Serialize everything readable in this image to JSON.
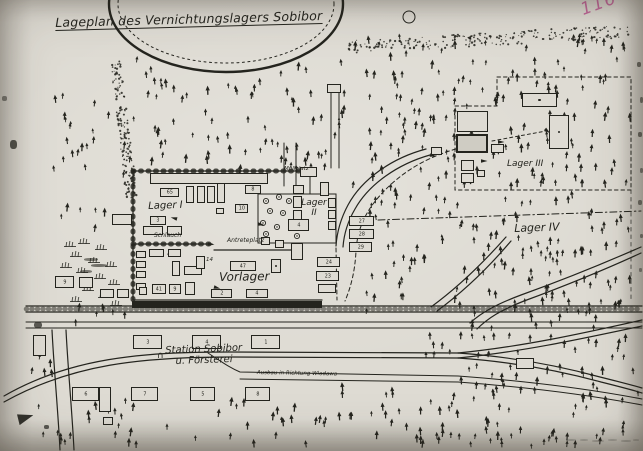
{
  "document": {
    "title": "Lageplan des Vernichtungslagers Sobibor",
    "page_annotation": "116"
  },
  "colors": {
    "paper": "#dedbd3",
    "ink": "#24241e",
    "annotation": "#b8538c"
  },
  "map": {
    "labels": [
      {
        "id": "lager-i",
        "text": "Lager I",
        "x": 148,
        "y": 201,
        "fs": 10,
        "rot": -2
      },
      {
        "id": "lager-ii",
        "text": "Lager\nII",
        "x": 299,
        "y": 198,
        "fs": 9,
        "w": 30,
        "align": "center"
      },
      {
        "id": "lager-iii",
        "text": "Lager III",
        "x": 507,
        "y": 159,
        "fs": 9
      },
      {
        "id": "lager-iv",
        "text": "Lager IV",
        "x": 514,
        "y": 223,
        "fs": 11,
        "rot": -2
      },
      {
        "id": "vorlager",
        "text": "Vorlager",
        "x": 219,
        "y": 271,
        "fs": 12,
        "rot": -1
      },
      {
        "id": "station",
        "text": "Station Sobibor\nu. Försterei",
        "x": 146,
        "y": 346,
        "fs": 10,
        "rot": -2,
        "w": 115,
        "align": "center"
      },
      {
        "id": "ausbau-richtung",
        "text": "Ausbau in Richtung Wlodawa",
        "x": 257,
        "y": 370,
        "fs": 5.5,
        "rot": 1
      },
      {
        "id": "schlauch",
        "text": "Schlauch",
        "x": 154,
        "y": 233,
        "fs": 6
      },
      {
        "id": "antreteplatz",
        "text": "Antreteplatz",
        "x": 227,
        "y": 238,
        "fs": 6
      },
      {
        "id": "muellplatz",
        "text": "Müllplatz",
        "x": 284,
        "y": 166,
        "fs": 5.5
      },
      {
        "id": "building-14-number",
        "text": "14",
        "x": 206,
        "y": 257,
        "fs": 5.5
      },
      {
        "id": "pen-arc-mark",
        "text": "∩",
        "x": 157,
        "y": 351,
        "fs": 9
      }
    ],
    "buildings": [
      {
        "x": 150,
        "y": 173,
        "w": 118,
        "h": 11,
        "n": ""
      },
      {
        "x": 160,
        "y": 188,
        "w": 19,
        "h": 9,
        "n": "65"
      },
      {
        "x": 186,
        "y": 186,
        "w": 8,
        "h": 17,
        "n": ""
      },
      {
        "x": 197,
        "y": 186,
        "w": 8,
        "h": 17,
        "n": ""
      },
      {
        "x": 207,
        "y": 186,
        "w": 8,
        "h": 17,
        "n": ""
      },
      {
        "x": 217,
        "y": 183,
        "w": 8,
        "h": 20,
        "n": ""
      },
      {
        "x": 245,
        "y": 185,
        "w": 16,
        "h": 9,
        "n": "8"
      },
      {
        "x": 112,
        "y": 214,
        "w": 20,
        "h": 11,
        "n": ""
      },
      {
        "x": 150,
        "y": 216,
        "w": 16,
        "h": 9,
        "n": "3"
      },
      {
        "x": 143,
        "y": 226,
        "w": 20,
        "h": 9,
        "n": ""
      },
      {
        "x": 167,
        "y": 226,
        "w": 15,
        "h": 9,
        "n": ""
      },
      {
        "x": 235,
        "y": 204,
        "w": 13,
        "h": 9,
        "n": "10"
      },
      {
        "x": 216,
        "y": 208,
        "w": 8,
        "h": 6,
        "n": ""
      },
      {
        "x": 293,
        "y": 185,
        "w": 11,
        "h": 9,
        "n": ""
      },
      {
        "x": 293,
        "y": 196,
        "w": 9,
        "h": 12,
        "n": ""
      },
      {
        "x": 293,
        "y": 210,
        "w": 9,
        "h": 10,
        "n": ""
      },
      {
        "x": 293,
        "y": 222,
        "w": 9,
        "h": 9,
        "n": ""
      },
      {
        "x": 291,
        "y": 243,
        "w": 12,
        "h": 17,
        "n": ""
      },
      {
        "x": 300,
        "y": 167,
        "w": 17,
        "h": 10,
        "n": ""
      },
      {
        "x": 327,
        "y": 84,
        "w": 14,
        "h": 9,
        "n": ""
      },
      {
        "x": 320,
        "y": 182,
        "w": 9,
        "h": 14,
        "n": ""
      },
      {
        "x": 328,
        "y": 198,
        "w": 8,
        "h": 10,
        "n": ""
      },
      {
        "x": 328,
        "y": 210,
        "w": 8,
        "h": 9,
        "n": ""
      },
      {
        "x": 328,
        "y": 221,
        "w": 8,
        "h": 9,
        "n": ""
      },
      {
        "x": 288,
        "y": 219,
        "w": 21,
        "h": 12,
        "n": "4"
      },
      {
        "x": 261,
        "y": 237,
        "w": 9,
        "h": 8,
        "n": ""
      },
      {
        "x": 275,
        "y": 240,
        "w": 9,
        "h": 8,
        "n": ""
      },
      {
        "x": 349,
        "y": 216,
        "w": 25,
        "h": 10,
        "n": "27"
      },
      {
        "x": 349,
        "y": 229,
        "w": 25,
        "h": 10,
        "n": "28"
      },
      {
        "x": 349,
        "y": 242,
        "w": 23,
        "h": 10,
        "n": "29"
      },
      {
        "x": 317,
        "y": 257,
        "w": 23,
        "h": 10,
        "n": "24"
      },
      {
        "x": 316,
        "y": 271,
        "w": 23,
        "h": 10,
        "n": "23"
      },
      {
        "x": 318,
        "y": 284,
        "w": 18,
        "h": 9,
        "n": ""
      },
      {
        "x": 136,
        "y": 251,
        "w": 10,
        "h": 7,
        "n": ""
      },
      {
        "x": 136,
        "y": 261,
        "w": 10,
        "h": 7,
        "n": ""
      },
      {
        "x": 136,
        "y": 271,
        "w": 10,
        "h": 7,
        "n": ""
      },
      {
        "x": 136,
        "y": 283,
        "w": 10,
        "h": 7,
        "n": ""
      },
      {
        "x": 149,
        "y": 249,
        "w": 15,
        "h": 8,
        "n": ""
      },
      {
        "x": 168,
        "y": 249,
        "w": 13,
        "h": 8,
        "n": ""
      },
      {
        "x": 172,
        "y": 261,
        "w": 8,
        "h": 15,
        "n": ""
      },
      {
        "x": 184,
        "y": 266,
        "w": 18,
        "h": 9,
        "n": ""
      },
      {
        "x": 196,
        "y": 256,
        "w": 9,
        "h": 13,
        "n": ""
      },
      {
        "x": 100,
        "y": 289,
        "w": 14,
        "h": 9,
        "n": ""
      },
      {
        "x": 117,
        "y": 289,
        "w": 12,
        "h": 9,
        "n": ""
      },
      {
        "x": 139,
        "y": 287,
        "w": 8,
        "h": 8,
        "n": ""
      },
      {
        "x": 152,
        "y": 284,
        "w": 14,
        "h": 10,
        "n": "41"
      },
      {
        "x": 169,
        "y": 284,
        "w": 12,
        "h": 10,
        "n": "9"
      },
      {
        "x": 185,
        "y": 282,
        "w": 10,
        "h": 13,
        "n": ""
      },
      {
        "x": 230,
        "y": 261,
        "w": 26,
        "h": 10,
        "n": "47"
      },
      {
        "x": 271,
        "y": 259,
        "w": 10,
        "h": 14,
        "n": "",
        "style": "dot"
      },
      {
        "x": 211,
        "y": 289,
        "w": 21,
        "h": 9,
        "n": "2"
      },
      {
        "x": 246,
        "y": 289,
        "w": 22,
        "h": 9,
        "n": "4"
      },
      {
        "x": 522,
        "y": 93,
        "w": 35,
        "h": 14,
        "n": "",
        "style": "dot"
      },
      {
        "x": 549,
        "y": 115,
        "w": 20,
        "h": 34,
        "n": "",
        "style": "dot"
      },
      {
        "x": 457,
        "y": 111,
        "w": 31,
        "h": 21,
        "n": ""
      },
      {
        "x": 456,
        "y": 134,
        "w": 32,
        "h": 19,
        "n": "",
        "style": "dark"
      },
      {
        "x": 491,
        "y": 144,
        "w": 13,
        "h": 9,
        "n": ""
      },
      {
        "x": 431,
        "y": 147,
        "w": 11,
        "h": 8,
        "n": ""
      },
      {
        "x": 461,
        "y": 160,
        "w": 13,
        "h": 11,
        "n": ""
      },
      {
        "x": 461,
        "y": 173,
        "w": 13,
        "h": 10,
        "n": ""
      },
      {
        "x": 477,
        "y": 170,
        "w": 8,
        "h": 7,
        "n": ""
      },
      {
        "x": 133,
        "y": 335,
        "w": 29,
        "h": 14,
        "n": "3"
      },
      {
        "x": 192,
        "y": 335,
        "w": 29,
        "h": 14,
        "n": "4"
      },
      {
        "x": 251,
        "y": 335,
        "w": 29,
        "h": 14,
        "n": "1"
      },
      {
        "x": 72,
        "y": 387,
        "w": 27,
        "h": 14,
        "n": "6"
      },
      {
        "x": 131,
        "y": 387,
        "w": 27,
        "h": 14,
        "n": "7"
      },
      {
        "x": 190,
        "y": 387,
        "w": 25,
        "h": 14,
        "n": "5"
      },
      {
        "x": 245,
        "y": 387,
        "w": 25,
        "h": 14,
        "n": "8"
      },
      {
        "x": 33,
        "y": 335,
        "w": 13,
        "h": 21,
        "n": ""
      },
      {
        "x": 99,
        "y": 387,
        "w": 12,
        "h": 25,
        "n": ""
      },
      {
        "x": 103,
        "y": 417,
        "w": 10,
        "h": 8,
        "n": ""
      },
      {
        "x": 55,
        "y": 276,
        "w": 19,
        "h": 12,
        "n": "9"
      },
      {
        "x": 79,
        "y": 277,
        "w": 14,
        "h": 11,
        "n": ""
      },
      {
        "x": 516,
        "y": 358,
        "w": 18,
        "h": 11,
        "n": ""
      }
    ],
    "forest_regions": [
      {
        "x0": 352,
        "y0": 36,
        "x1": 630,
        "y1": 188,
        "count": 170,
        "seed": 7,
        "excl": [
          [
            500,
            153,
            50,
            18
          ]
        ]
      },
      {
        "x0": 128,
        "y0": 52,
        "x1": 348,
        "y1": 170,
        "count": 80,
        "seed": 13,
        "excl_ellipse": [
          226,
          4,
          122,
          74
        ]
      },
      {
        "x0": 438,
        "y0": 194,
        "x1": 634,
        "y1": 332,
        "count": 115,
        "seed": 21,
        "excl": [
          [
            505,
            218,
            60,
            18
          ]
        ]
      },
      {
        "x0": 366,
        "y0": 190,
        "x1": 438,
        "y1": 320,
        "count": 32,
        "seed": 77
      },
      {
        "x0": 420,
        "y0": 334,
        "x1": 636,
        "y1": 382,
        "count": 42,
        "seed": 55
      },
      {
        "x0": 300,
        "y0": 384,
        "x1": 638,
        "y1": 446,
        "count": 88,
        "seed": 33
      },
      {
        "x0": 34,
        "y0": 400,
        "x1": 300,
        "y1": 446,
        "count": 36,
        "seed": 34
      },
      {
        "x0": 52,
        "y0": 95,
        "x1": 126,
        "y1": 228,
        "count": 26,
        "seed": 66
      },
      {
        "x0": 52,
        "y0": 305,
        "x1": 126,
        "y1": 328,
        "count": 7,
        "seed": 67
      },
      {
        "x0": 28,
        "y0": 340,
        "x1": 60,
        "y1": 398,
        "count": 6,
        "seed": 68
      }
    ],
    "stipple_bands": [
      {
        "x0": 348,
        "y0": 47,
        "x1": 630,
        "y1": 31,
        "th": 13,
        "count": 230,
        "seed": 91
      },
      {
        "x0": 115,
        "y0": 62,
        "x1": 132,
        "y1": 198,
        "th": 11,
        "count": 160,
        "seed": 92
      }
    ],
    "courtyard_trees": [
      [
        266,
        201,
        2.6
      ],
      [
        279,
        197,
        2.6
      ],
      [
        289,
        201,
        2.6
      ],
      [
        270,
        211,
        2.6
      ],
      [
        283,
        213,
        2.6
      ],
      [
        263,
        223,
        2.6
      ],
      [
        277,
        227,
        2.6
      ],
      [
        266,
        234,
        2.6
      ],
      [
        297,
        236,
        2.6
      ],
      [
        303,
        228,
        2.6
      ],
      [
        464,
        117,
        1.8
      ],
      [
        473,
        121,
        1.8
      ],
      [
        481,
        116,
        1.8
      ],
      [
        466,
        127,
        1.8
      ],
      [
        479,
        127,
        1.8
      ]
    ],
    "arrows": [
      [
        208,
        244,
        5
      ],
      [
        168,
        253,
        25
      ],
      [
        214,
        287,
        15
      ],
      [
        294,
        251,
        0
      ],
      [
        258,
        224,
        10
      ],
      [
        177,
        219,
        195
      ],
      [
        430,
        155,
        12
      ],
      [
        481,
        161,
        0
      ],
      [
        498,
        142,
        0
      ],
      [
        545,
        129,
        40
      ]
    ],
    "marsh": [
      [
        78,
        238
      ],
      [
        95,
        244
      ],
      [
        70,
        251
      ],
      [
        88,
        257
      ],
      [
        105,
        261
      ],
      [
        76,
        267
      ],
      [
        94,
        273
      ],
      [
        108,
        279
      ],
      [
        82,
        285
      ],
      [
        98,
        292
      ],
      [
        70,
        296
      ],
      [
        110,
        300
      ],
      [
        64,
        241
      ],
      [
        60,
        262
      ]
    ],
    "specks": [
      [
        10,
        140,
        7,
        9,
        0.75
      ],
      [
        34,
        322,
        8,
        6,
        0.7
      ],
      [
        2,
        96,
        5,
        5,
        0.5
      ],
      [
        637,
        62,
        4,
        5,
        0.6
      ],
      [
        640,
        97,
        3,
        6,
        0.55
      ],
      [
        638,
        132,
        4,
        5,
        0.6
      ],
      [
        640,
        168,
        3,
        5,
        0.5
      ],
      [
        638,
        200,
        4,
        5,
        0.55
      ],
      [
        640,
        234,
        3,
        4,
        0.5
      ],
      [
        639,
        268,
        3,
        4,
        0.45
      ],
      [
        44,
        425,
        5,
        4,
        0.7
      ],
      [
        84,
        258,
        14,
        3,
        0.55
      ],
      [
        91,
        264,
        16,
        3,
        0.6
      ],
      [
        80,
        270,
        12,
        3,
        0.55
      ],
      [
        566,
        439,
        10,
        2,
        0.22
      ],
      [
        580,
        439,
        8,
        2,
        0.2
      ],
      [
        592,
        440,
        12,
        2,
        0.22
      ],
      [
        608,
        439,
        9,
        2,
        0.2
      ],
      [
        621,
        440,
        10,
        2,
        0.22
      ],
      [
        633,
        439,
        6,
        2,
        0.18
      ]
    ]
  }
}
